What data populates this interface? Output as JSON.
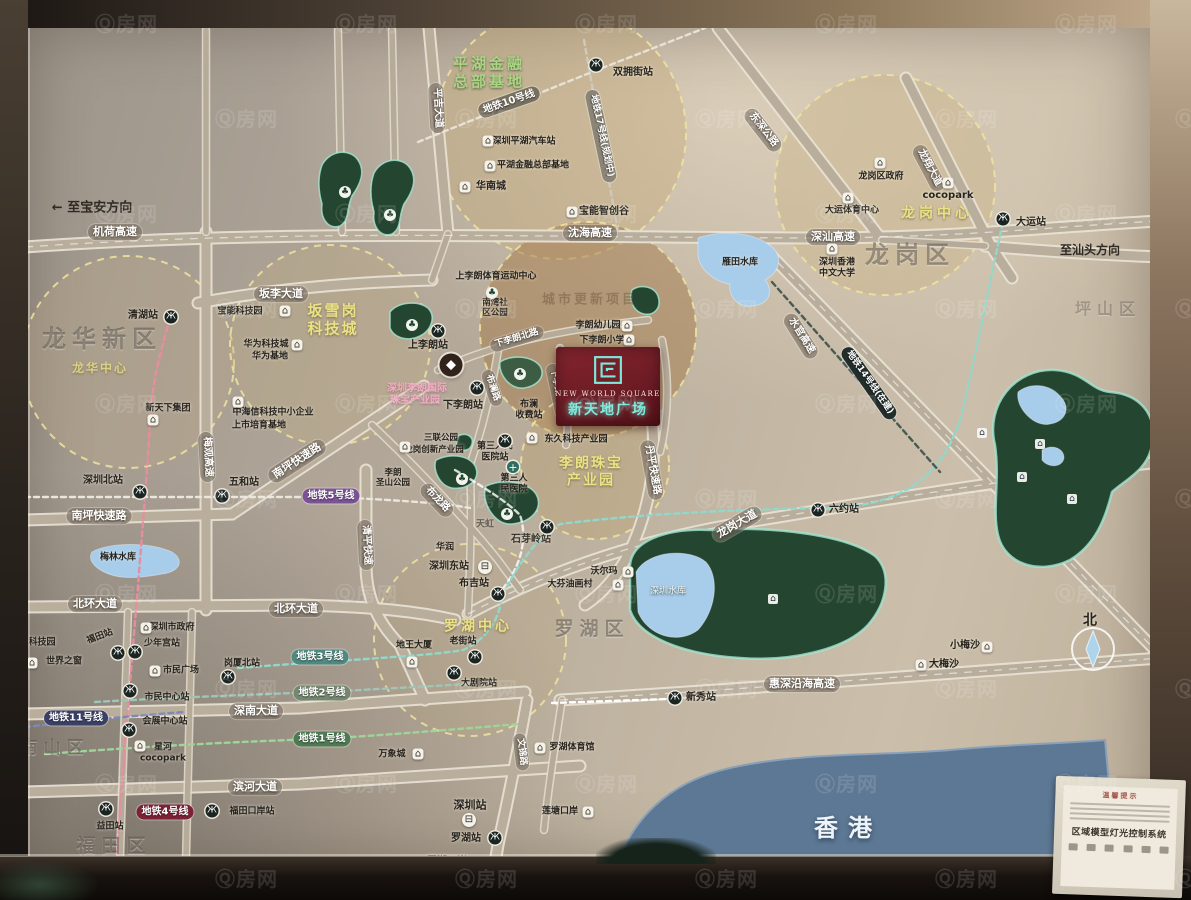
{
  "watermark": {
    "text": "Ⓠ房网"
  },
  "project": {
    "en": "NEW  WORLD  SQUARE",
    "cn": "新天地广场",
    "name": "新天地广场"
  },
  "panel": {
    "title": "温馨提示",
    "system": "区域模型灯光控制系统"
  },
  "compass": {
    "north": "北"
  },
  "map": {
    "icon_glyphs": {
      "metro": "Ж",
      "poi": "⌂",
      "pw": "⌂",
      "train": "⊟",
      "hosp": "+",
      "park": "♣",
      "gem": "◆"
    },
    "labels": [
      {
        "t": "平湖金融\n总部基地",
        "x": 489,
        "y": 73,
        "c": "gz",
        "n": "zone-label-pinghu-finance"
      },
      {
        "t": "坂雪岗\n科技城",
        "x": 333,
        "y": 320,
        "c": "yz",
        "fs": 15,
        "n": "zone-label-banxuegang"
      },
      {
        "t": "龙岗中心",
        "x": 937,
        "y": 214,
        "c": "yz",
        "fs": 14,
        "ls": 4,
        "n": "zone-label-longgang-center"
      },
      {
        "t": "龙华中心",
        "x": 100,
        "y": 368,
        "c": "yz",
        "fs": 12,
        "op": 0.75,
        "n": "zone-label-longhua-center"
      },
      {
        "t": "李朗珠宝\n产业园",
        "x": 591,
        "y": 472,
        "c": "yz",
        "fs": 14,
        "n": "zone-label-lilang-jewelry"
      },
      {
        "t": "罗湖中心",
        "x": 478,
        "y": 627,
        "c": "yz",
        "fs": 14,
        "ls": 3,
        "n": "zone-label-luohu-center"
      },
      {
        "t": "城市更新项目",
        "x": 590,
        "y": 300,
        "c": "faint",
        "fs": 13,
        "n": "zone-label-urban-renewal"
      },
      {
        "t": "龙华新区",
        "x": 102,
        "y": 339,
        "c": "reg",
        "fs": 24,
        "n": "district-label-longhua"
      },
      {
        "t": "龙岗区",
        "x": 910,
        "y": 255,
        "c": "reg",
        "fs": 24,
        "n": "district-label-longgang"
      },
      {
        "t": "罗湖区",
        "x": 592,
        "y": 629,
        "c": "reg",
        "fs": 19,
        "n": "district-label-luohu"
      },
      {
        "t": "南山区",
        "x": 55,
        "y": 748,
        "c": "reg",
        "fs": 17,
        "n": "district-label-nanshan"
      },
      {
        "t": "福田区",
        "x": 114,
        "y": 846,
        "c": "reg",
        "fs": 19,
        "n": "district-label-futian"
      },
      {
        "t": "坪山区",
        "x": 1108,
        "y": 310,
        "c": "reg",
        "fs": 16,
        "op": 0.7,
        "n": "district-label-pingshan"
      },
      {
        "t": "香港",
        "x": 848,
        "y": 828,
        "c": "hk",
        "n": "region-label-hongkong"
      },
      {
        "t": "← 至宝安方向",
        "x": 92,
        "y": 208,
        "c": "dir",
        "n": "direction-baoan"
      },
      {
        "t": "至汕头方向",
        "x": 1090,
        "y": 250,
        "c": "dir",
        "fs": 12,
        "n": "direction-shantou"
      },
      {
        "t": "北",
        "x": 1090,
        "y": 621,
        "c": "poi",
        "fs": 14,
        "n": "compass-north-label"
      },
      {
        "t": "机荷高速",
        "x": 115,
        "y": 232,
        "c": "rb"
      },
      {
        "t": "沈海高速",
        "x": 590,
        "y": 233,
        "c": "rb"
      },
      {
        "t": "深汕高速",
        "x": 833,
        "y": 237,
        "c": "rb"
      },
      {
        "t": "坂李大道",
        "x": 281,
        "y": 294,
        "c": "rb"
      },
      {
        "t": "南坪快速路",
        "x": 99,
        "y": 516,
        "c": "rb"
      },
      {
        "t": "南坪快速路",
        "x": 297,
        "y": 461,
        "c": "rb",
        "rot": -33
      },
      {
        "t": "北环大道",
        "x": 95,
        "y": 604,
        "c": "rb"
      },
      {
        "t": "北环大道",
        "x": 296,
        "y": 609,
        "c": "rb"
      },
      {
        "t": "深南大道",
        "x": 256,
        "y": 711,
        "c": "rb"
      },
      {
        "t": "滨河大道",
        "x": 255,
        "y": 787,
        "c": "rb"
      },
      {
        "t": "惠深沿海高速",
        "x": 802,
        "y": 684,
        "c": "rb"
      },
      {
        "t": "龙岗大道",
        "x": 737,
        "y": 524,
        "c": "rb",
        "rot": -30
      },
      {
        "t": "丹平快速路",
        "x": 652,
        "y": 470,
        "c": "rb",
        "rot": 80,
        "fs": 10
      },
      {
        "t": "水官高速",
        "x": 801,
        "y": 336,
        "c": "rb",
        "rot": 58,
        "fs": 10
      },
      {
        "t": "东深公路",
        "x": 763,
        "y": 130,
        "c": "rb",
        "rot": 52,
        "fs": 10
      },
      {
        "t": "龙翔大道",
        "x": 929,
        "y": 168,
        "c": "rb",
        "rot": 62,
        "fs": 10
      },
      {
        "t": "平吉大道",
        "x": 437,
        "y": 108,
        "c": "rb",
        "rot": 87,
        "fs": 10
      },
      {
        "t": "梅观高速",
        "x": 207,
        "y": 457,
        "c": "rb",
        "rot": 87,
        "fs": 10
      },
      {
        "t": "清平快速",
        "x": 366,
        "y": 545,
        "c": "rb",
        "rot": 87,
        "fs": 10
      },
      {
        "t": "布龙路",
        "x": 437,
        "y": 500,
        "c": "rb",
        "rot": 46,
        "fs": 10
      },
      {
        "t": "布澜路",
        "x": 492,
        "y": 388,
        "c": "rb",
        "rot": 72,
        "fs": 9
      },
      {
        "t": "下李朗北路",
        "x": 517,
        "y": 339,
        "c": "rb",
        "rot": -17,
        "fs": 9
      },
      {
        "t": "下李朗南路",
        "x": 557,
        "y": 391,
        "c": "rb",
        "rot": 78,
        "fs": 9
      },
      {
        "t": "文锦路",
        "x": 521,
        "y": 752,
        "c": "rb",
        "rot": 83,
        "fs": 9
      },
      {
        "t": "地铁10号线",
        "x": 509,
        "y": 102,
        "c": "mb",
        "rot": -19,
        "bg": "#77705f"
      },
      {
        "t": "地铁17号线(规划中)",
        "x": 601,
        "y": 136,
        "c": "mb",
        "rot": 78,
        "bg": "#8b8577",
        "fs": 9
      },
      {
        "t": "地铁5号线",
        "x": 331,
        "y": 496,
        "c": "mb",
        "bg": "#7b5296"
      },
      {
        "t": "地铁3号线",
        "x": 320,
        "y": 657,
        "c": "mb",
        "bg": "#4f8a80"
      },
      {
        "t": "地铁2号线",
        "x": 322,
        "y": 693,
        "c": "mb",
        "bg": "#74876f"
      },
      {
        "t": "地铁1号线",
        "x": 322,
        "y": 739,
        "c": "mb",
        "bg": "#4d7a52"
      },
      {
        "t": "地铁11号线",
        "x": 76,
        "y": 718,
        "c": "mb",
        "bg": "#3a4066"
      },
      {
        "t": "地铁4号线",
        "x": 165,
        "y": 812,
        "c": "mb",
        "bg": "#7c2136"
      },
      {
        "t": "地铁14号线(在建)",
        "x": 869,
        "y": 383,
        "c": "mb",
        "rot": 55,
        "bg": "#222e2b",
        "fs": 9
      },
      {
        "t": "双拥街站",
        "x": 633,
        "y": 73,
        "c": "poi"
      },
      {
        "t": "清湖站",
        "x": 143,
        "y": 316,
        "c": "poi"
      },
      {
        "t": "深圳北站",
        "x": 103,
        "y": 481,
        "c": "poi"
      },
      {
        "t": "五和站",
        "x": 244,
        "y": 483,
        "c": "poi"
      },
      {
        "t": "上李朗站",
        "x": 428,
        "y": 346,
        "c": "poi"
      },
      {
        "t": "下李朗站",
        "x": 463,
        "y": 406,
        "c": "poi"
      },
      {
        "t": "第三人民\n医院站",
        "x": 495,
        "y": 452,
        "c": "poi",
        "fs": 9
      },
      {
        "t": "第三人\n民医院",
        "x": 514,
        "y": 484,
        "c": "poi",
        "fs": 9
      },
      {
        "t": "石芽岭站",
        "x": 531,
        "y": 540,
        "c": "poi",
        "op": 0.85
      },
      {
        "t": "布吉站",
        "x": 474,
        "y": 584,
        "c": "poi"
      },
      {
        "t": "深圳东站",
        "x": 449,
        "y": 567,
        "c": "poi"
      },
      {
        "t": "六约站",
        "x": 844,
        "y": 510,
        "c": "poi"
      },
      {
        "t": "新秀站",
        "x": 701,
        "y": 698,
        "c": "poi"
      },
      {
        "t": "大运站",
        "x": 1031,
        "y": 223,
        "c": "poi"
      },
      {
        "t": "岗厦北站",
        "x": 242,
        "y": 664,
        "c": "poi",
        "fs": 9
      },
      {
        "t": "福田站",
        "x": 100,
        "y": 637,
        "c": "poi",
        "rot": -20,
        "fs": 9
      },
      {
        "t": "少年宫站",
        "x": 162,
        "y": 644,
        "c": "poi",
        "fs": 9
      },
      {
        "t": "深圳市政府",
        "x": 172,
        "y": 628,
        "c": "poi",
        "fs": 9
      },
      {
        "t": "市民广场",
        "x": 181,
        "y": 671,
        "c": "poi",
        "fs": 9
      },
      {
        "t": "市民中心站",
        "x": 167,
        "y": 698,
        "c": "poi",
        "fs": 9
      },
      {
        "t": "会展中心站",
        "x": 165,
        "y": 722,
        "c": "poi",
        "fs": 9
      },
      {
        "t": "星河\ncocopark",
        "x": 163,
        "y": 753,
        "c": "poi",
        "fs": 9
      },
      {
        "t": "科技园",
        "x": 42,
        "y": 643,
        "c": "poi",
        "fs": 9
      },
      {
        "t": "世界之窗",
        "x": 64,
        "y": 662,
        "c": "poi",
        "fs": 9
      },
      {
        "t": "益田站",
        "x": 110,
        "y": 827,
        "c": "poi",
        "fs": 9
      },
      {
        "t": "福田口岸站",
        "x": 252,
        "y": 812,
        "c": "poi",
        "fs": 9
      },
      {
        "t": "深圳站",
        "x": 470,
        "y": 806,
        "c": "poi",
        "fs": 11
      },
      {
        "t": "罗湖站",
        "x": 466,
        "y": 839,
        "c": "poi"
      },
      {
        "t": "罗湖口岸",
        "x": 447,
        "y": 862,
        "c": "poi"
      },
      {
        "t": "莲塘口岸",
        "x": 560,
        "y": 812,
        "c": "poi",
        "fs": 9
      },
      {
        "t": "万象城",
        "x": 392,
        "y": 755,
        "c": "poi",
        "fs": 9
      },
      {
        "t": "罗湖体育馆",
        "x": 572,
        "y": 748,
        "c": "poi",
        "fs": 9
      },
      {
        "t": "老街站",
        "x": 463,
        "y": 642,
        "c": "poi",
        "fs": 9
      },
      {
        "t": "大剧院站",
        "x": 479,
        "y": 684,
        "c": "poi",
        "fs": 9
      },
      {
        "t": "地王大厦",
        "x": 414,
        "y": 646,
        "c": "poi",
        "fs": 9
      },
      {
        "t": "沃尔玛",
        "x": 604,
        "y": 572,
        "c": "poi",
        "fs": 9
      },
      {
        "t": "大芬油画村",
        "x": 570,
        "y": 585,
        "c": "poi",
        "fs": 9
      },
      {
        "t": "华润",
        "x": 445,
        "y": 548,
        "c": "poi",
        "fs": 9
      },
      {
        "t": "天虹",
        "x": 485,
        "y": 525,
        "c": "poi",
        "fs": 9,
        "op": 0.55
      },
      {
        "t": "深圳平湖汽车站",
        "x": 524,
        "y": 142,
        "c": "poi",
        "fs": 9
      },
      {
        "t": "平湖金融总部基地",
        "x": 533,
        "y": 166,
        "c": "poi",
        "fs": 9
      },
      {
        "t": "华南城",
        "x": 491,
        "y": 187,
        "c": "poi"
      },
      {
        "t": "宝能智创谷",
        "x": 604,
        "y": 212,
        "c": "poi"
      },
      {
        "t": "龙岗区政府",
        "x": 881,
        "y": 177,
        "c": "poi",
        "fs": 9
      },
      {
        "t": "cocopark",
        "x": 948,
        "y": 196,
        "c": "poi"
      },
      {
        "t": "大运体育中心",
        "x": 852,
        "y": 211,
        "c": "poi",
        "fs": 9
      },
      {
        "t": "深圳香港\n中文大学",
        "x": 837,
        "y": 268,
        "c": "poi",
        "fs": 9
      },
      {
        "t": "宝能科技园",
        "x": 240,
        "y": 312,
        "c": "poi",
        "fs": 9
      },
      {
        "t": "华为科技城",
        "x": 266,
        "y": 345,
        "c": "poi",
        "fs": 9
      },
      {
        "t": "华为基地",
        "x": 270,
        "y": 357,
        "c": "poi",
        "fs": 9
      },
      {
        "t": "中海信科技中小企业",
        "x": 273,
        "y": 413,
        "c": "poi",
        "fs": 9
      },
      {
        "t": "上市培育基地",
        "x": 259,
        "y": 426,
        "c": "poi",
        "fs": 9
      },
      {
        "t": "新天下集团",
        "x": 168,
        "y": 409,
        "c": "poi",
        "fs": 9
      },
      {
        "t": "三联公园",
        "x": 441,
        "y": 438,
        "c": "poi",
        "fs": 8.5
      },
      {
        "t": "龙岗创新产业园",
        "x": 434,
        "y": 450,
        "c": "poi",
        "fs": 8.5
      },
      {
        "t": "东久科技产业园",
        "x": 576,
        "y": 440,
        "c": "poi",
        "fs": 9
      },
      {
        "t": "布澜\n收费站",
        "x": 529,
        "y": 410,
        "c": "poi",
        "fs": 9
      },
      {
        "t": "南湾社\n区公园",
        "x": 495,
        "y": 308,
        "c": "poi",
        "fs": 8.5
      },
      {
        "t": "上李朗体育运动中心",
        "x": 496,
        "y": 277,
        "c": "poi",
        "fs": 9
      },
      {
        "t": "李朗幼儿园",
        "x": 598,
        "y": 326,
        "c": "poi",
        "fs": 9
      },
      {
        "t": "下李朗小学",
        "x": 602,
        "y": 341,
        "c": "poi",
        "fs": 9
      },
      {
        "t": "李朗\n圣山公园",
        "x": 393,
        "y": 478,
        "c": "poi",
        "fs": 8.5
      },
      {
        "t": "深圳李朗国际",
        "x": 417,
        "y": 389,
        "c": "pz"
      },
      {
        "t": "珠宝产业园",
        "x": 415,
        "y": 401,
        "c": "pz"
      },
      {
        "t": "深圳水库",
        "x": 668,
        "y": 592,
        "c": "poiw"
      },
      {
        "t": "梅林水库",
        "x": 118,
        "y": 558,
        "c": "poi",
        "fs": 9
      },
      {
        "t": "雁田水库",
        "x": 740,
        "y": 263,
        "c": "poi",
        "fs": 9
      },
      {
        "t": "大梅沙",
        "x": 944,
        "y": 665,
        "c": "poi"
      },
      {
        "t": "小梅沙",
        "x": 965,
        "y": 646,
        "c": "poi"
      }
    ],
    "icons": [
      {
        "k": "metro",
        "x": 596,
        "y": 65
      },
      {
        "k": "metro",
        "x": 171,
        "y": 317
      },
      {
        "k": "metro",
        "x": 140,
        "y": 492
      },
      {
        "k": "metro",
        "x": 222,
        "y": 496
      },
      {
        "k": "metro",
        "x": 438,
        "y": 331
      },
      {
        "k": "metro",
        "x": 477,
        "y": 388
      },
      {
        "k": "metro",
        "x": 505,
        "y": 441
      },
      {
        "k": "metro",
        "x": 547,
        "y": 527
      },
      {
        "k": "metro",
        "x": 498,
        "y": 594
      },
      {
        "k": "metro",
        "x": 818,
        "y": 510
      },
      {
        "k": "metro",
        "x": 675,
        "y": 698
      },
      {
        "k": "metro",
        "x": 1003,
        "y": 219
      },
      {
        "k": "metro",
        "x": 228,
        "y": 677
      },
      {
        "k": "metro",
        "x": 118,
        "y": 653
      },
      {
        "k": "metro",
        "x": 135,
        "y": 652
      },
      {
        "k": "metro",
        "x": 130,
        "y": 691
      },
      {
        "k": "metro",
        "x": 129,
        "y": 730
      },
      {
        "k": "metro",
        "x": 106,
        "y": 809
      },
      {
        "k": "metro",
        "x": 212,
        "y": 811
      },
      {
        "k": "metro",
        "x": 495,
        "y": 838
      },
      {
        "k": "metro",
        "x": 475,
        "y": 657
      },
      {
        "k": "metro",
        "x": 454,
        "y": 673
      },
      {
        "k": "train",
        "x": 485,
        "y": 567
      },
      {
        "k": "train",
        "x": 469,
        "y": 820
      },
      {
        "k": "hosp",
        "x": 513,
        "y": 467
      },
      {
        "k": "gem",
        "x": 451,
        "y": 365
      },
      {
        "k": "park",
        "x": 345,
        "y": 192
      },
      {
        "k": "park",
        "x": 390,
        "y": 215
      },
      {
        "k": "park",
        "x": 412,
        "y": 325
      },
      {
        "k": "park",
        "x": 492,
        "y": 293
      },
      {
        "k": "park",
        "x": 520,
        "y": 374
      },
      {
        "k": "park",
        "x": 462,
        "y": 479
      },
      {
        "k": "park",
        "x": 507,
        "y": 514
      },
      {
        "k": "poi",
        "x": 488,
        "y": 141
      },
      {
        "k": "poi",
        "x": 490,
        "y": 166
      },
      {
        "k": "poi",
        "x": 465,
        "y": 187
      },
      {
        "k": "poi",
        "x": 572,
        "y": 212
      },
      {
        "k": "poi",
        "x": 285,
        "y": 311
      },
      {
        "k": "poi",
        "x": 297,
        "y": 345
      },
      {
        "k": "poi",
        "x": 238,
        "y": 402
      },
      {
        "k": "poi",
        "x": 153,
        "y": 420
      },
      {
        "k": "poi",
        "x": 405,
        "y": 447
      },
      {
        "k": "poi",
        "x": 532,
        "y": 438
      },
      {
        "k": "poi",
        "x": 880,
        "y": 163
      },
      {
        "k": "poi",
        "x": 948,
        "y": 183
      },
      {
        "k": "poi",
        "x": 848,
        "y": 198
      },
      {
        "k": "poi",
        "x": 832,
        "y": 249
      },
      {
        "k": "poi",
        "x": 146,
        "y": 628
      },
      {
        "k": "poi",
        "x": 155,
        "y": 671
      },
      {
        "k": "poi",
        "x": 18,
        "y": 643
      },
      {
        "k": "poi",
        "x": 32,
        "y": 663
      },
      {
        "k": "poi",
        "x": 140,
        "y": 746
      },
      {
        "k": "poi",
        "x": 412,
        "y": 662
      },
      {
        "k": "poi",
        "x": 418,
        "y": 754
      },
      {
        "k": "poi",
        "x": 540,
        "y": 748
      },
      {
        "k": "poi",
        "x": 628,
        "y": 572
      },
      {
        "k": "poi",
        "x": 618,
        "y": 585
      },
      {
        "k": "poi",
        "x": 478,
        "y": 862
      },
      {
        "k": "poi",
        "x": 588,
        "y": 812
      },
      {
        "k": "poi",
        "x": 921,
        "y": 665
      },
      {
        "k": "poi",
        "x": 987,
        "y": 647
      },
      {
        "k": "poi",
        "x": 627,
        "y": 326
      },
      {
        "k": "poi",
        "x": 629,
        "y": 340
      },
      {
        "k": "pw",
        "x": 773,
        "y": 599
      },
      {
        "k": "pw",
        "x": 982,
        "y": 433
      },
      {
        "k": "pw",
        "x": 1040,
        "y": 444
      },
      {
        "k": "pw",
        "x": 1022,
        "y": 477
      },
      {
        "k": "pw",
        "x": 1072,
        "y": 499
      }
    ]
  }
}
